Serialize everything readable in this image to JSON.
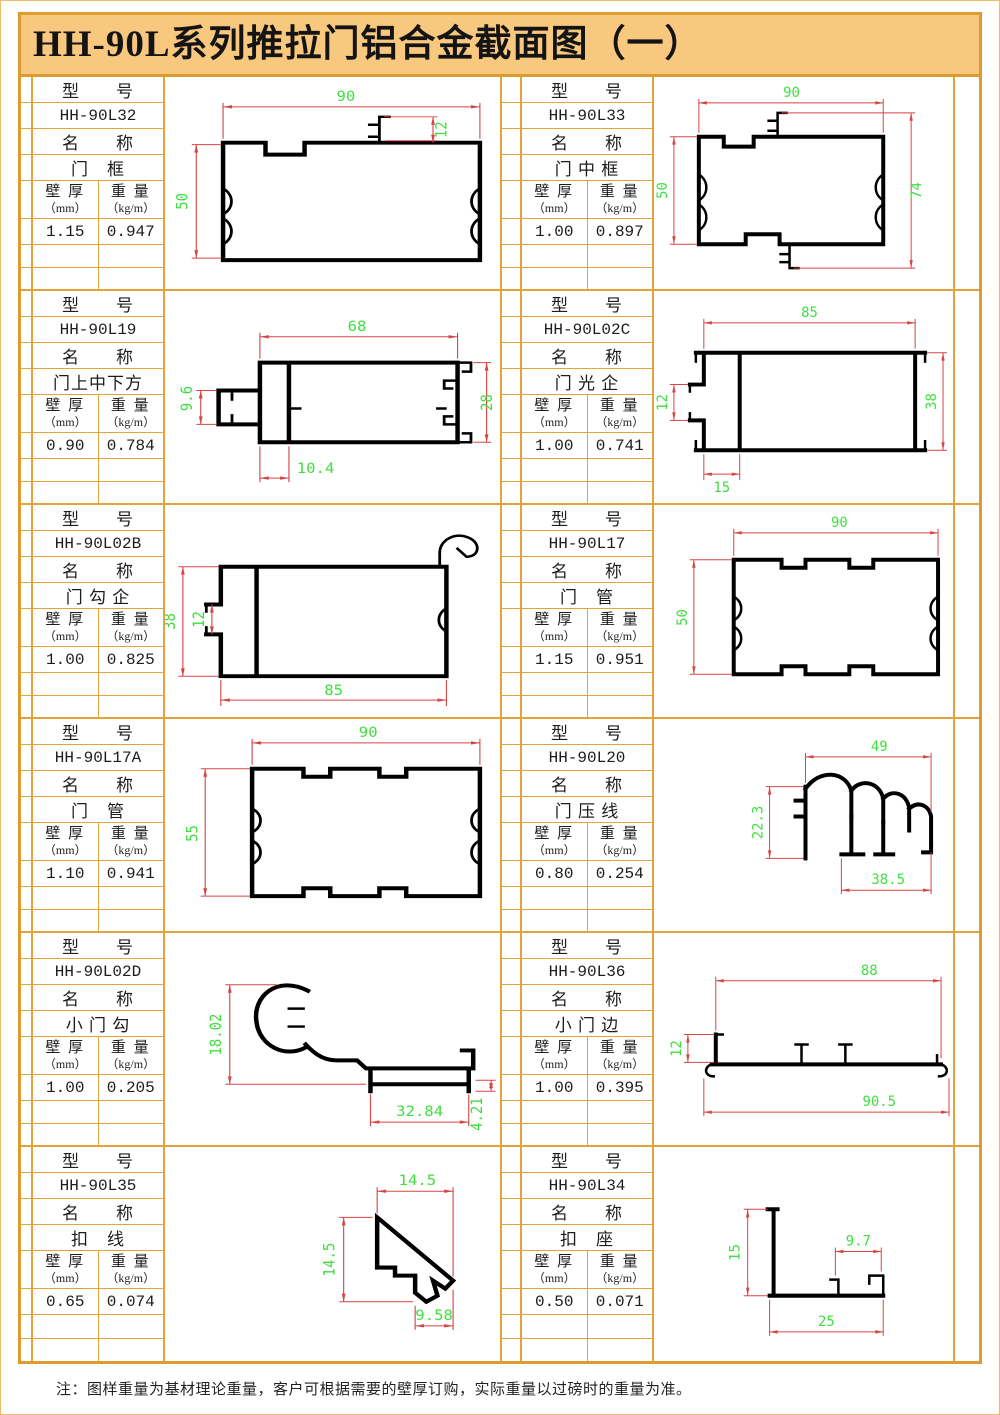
{
  "title": "HH-90L系列推拉门铝合金截面图（一）",
  "note": "注：图样重量为基材理论重量，客户可根据需要的壁厚订购，实际重量以过磅时的重量为准。",
  "labels": {
    "model_label": "型　　号",
    "name_label": "名　　称",
    "thickness_label": "壁 厚",
    "thickness_unit": "（mm）",
    "weight_label": "重 量",
    "weight_unit": "（kg/m）"
  },
  "colors": {
    "frame_border": "#DC9C30",
    "cell_border": "#E2A23C",
    "title_bg": "#F8C87E",
    "dimension_line": "#D64545",
    "dimension_text": "#3FDF3F",
    "profile": "#000000"
  },
  "panels": [
    {
      "model": "HH-90L32",
      "name": "门　框",
      "thickness": "1.15",
      "weight": "0.947",
      "dims": [
        "90",
        "12",
        "50"
      ]
    },
    {
      "model": "HH-90L33",
      "name": "门 中 框",
      "thickness": "1.00",
      "weight": "0.897",
      "dims": [
        "90",
        "50",
        "74"
      ]
    },
    {
      "model": "HH-90L19",
      "name": "门上中下方",
      "thickness": "0.90",
      "weight": "0.784",
      "dims": [
        "68",
        "9.6",
        "28",
        "10.4"
      ]
    },
    {
      "model": "HH-90L02C",
      "name": "门 光 企",
      "thickness": "1.00",
      "weight": "0.741",
      "dims": [
        "85",
        "12",
        "38",
        "15"
      ]
    },
    {
      "model": "HH-90L02B",
      "name": "门 勾 企",
      "thickness": "1.00",
      "weight": "0.825",
      "dims": [
        "38",
        "12",
        "85"
      ]
    },
    {
      "model": "HH-90L17",
      "name": "门　管",
      "thickness": "1.15",
      "weight": "0.951",
      "dims": [
        "90",
        "50"
      ]
    },
    {
      "model": "HH-90L17A",
      "name": "门　管",
      "thickness": "1.10",
      "weight": "0.941",
      "dims": [
        "90",
        "55"
      ]
    },
    {
      "model": "HH-90L20",
      "name": "门 压 线",
      "thickness": "0.80",
      "weight": "0.254",
      "dims": [
        "49",
        "22.3",
        "38.5"
      ]
    },
    {
      "model": "HH-90L02D",
      "name": "小 门 勾",
      "thickness": "1.00",
      "weight": "0.205",
      "dims": [
        "18.02",
        "32.84",
        "4.21"
      ]
    },
    {
      "model": "HH-90L36",
      "name": "小 门 边",
      "thickness": "1.00",
      "weight": "0.395",
      "dims": [
        "88",
        "12",
        "90.5"
      ]
    },
    {
      "model": "HH-90L35",
      "name": "扣　线",
      "thickness": "0.65",
      "weight": "0.074",
      "dims": [
        "14.5",
        "14.5",
        "9.58"
      ]
    },
    {
      "model": "HH-90L34",
      "name": "扣　座",
      "thickness": "0.50",
      "weight": "0.071",
      "dims": [
        "15",
        "9.7",
        "25"
      ]
    }
  ]
}
